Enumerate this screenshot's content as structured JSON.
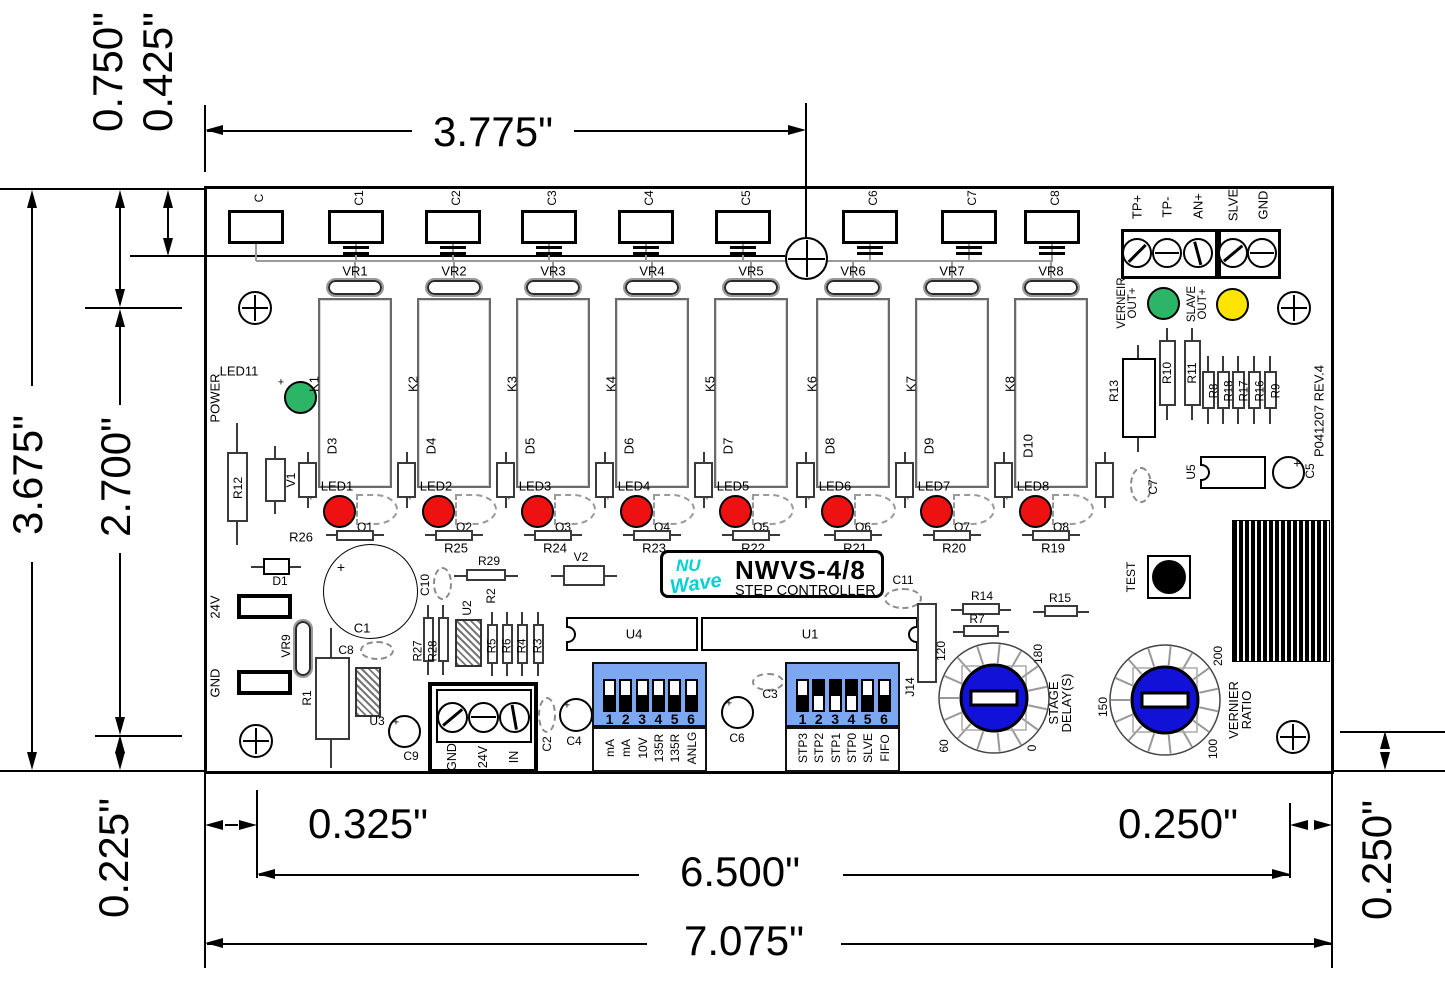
{
  "plus": "+",
  "dims": {
    "d0750": "0.750\"",
    "d0425": "0.425\"",
    "d3775": "3.775\"",
    "d3675": "3.675\"",
    "d2700": "2.700\"",
    "d0225": "0.225\"",
    "d0325": "0.325\"",
    "d6500": "6.500\"",
    "d0250b": "0.250\"",
    "d7075": "7.075\"",
    "d0250r": "0.250\""
  },
  "logo": {
    "nu": "NU",
    "wave": "Wave",
    "model": "NWVS-4/8",
    "subtitle": "STEP CONTROLLER",
    "accent": "#00d2d2"
  },
  "rev": "P041207 REV.4",
  "top_caps": [
    "C",
    "C1",
    "C2",
    "C3",
    "C4",
    "C5",
    "C6",
    "C7",
    "C8"
  ],
  "columns": [
    {
      "vr": "VR1",
      "k": "K1",
      "d": "D3",
      "led": "LED1",
      "q": "Q1",
      "r": "R26"
    },
    {
      "vr": "VR2",
      "k": "K2",
      "d": "D4",
      "led": "LED2",
      "q": "Q2",
      "r": "R25"
    },
    {
      "vr": "VR3",
      "k": "K3",
      "d": "D5",
      "led": "LED3",
      "q": "Q3",
      "r": "R24"
    },
    {
      "vr": "VR4",
      "k": "K4",
      "d": "D6",
      "led": "LED4",
      "q": "Q4",
      "r": "R23"
    },
    {
      "vr": "VR5",
      "k": "K5",
      "d": "D7",
      "led": "LED5",
      "q": "Q5",
      "r": "R22"
    },
    {
      "vr": "VR6",
      "k": "K6",
      "d": "D8",
      "led": "LED6",
      "q": "Q6",
      "r": "R21"
    },
    {
      "vr": "VR7",
      "k": "K7",
      "d": "D9",
      "led": "LED7",
      "q": "Q7",
      "r": "R20"
    },
    {
      "vr": "VR8",
      "k": "K8",
      "d": "D10",
      "led": "LED8",
      "q": "Q8",
      "r": "R19"
    }
  ],
  "io_block": {
    "labels": [
      "TP+",
      "TP-",
      "AN+",
      "SLVE",
      "GND"
    ]
  },
  "outputs": {
    "vernier_line1": "VERNEIR",
    "vernier_line2": "OUT",
    "vernier_color": "#2db567",
    "slave_line1": "SLAVE",
    "slave_line2": "OUT",
    "slave_color": "#ffe400"
  },
  "power": {
    "label": "POWER",
    "ref": "LED11",
    "color": "#2db567"
  },
  "right_parts": {
    "r13": "R13",
    "r10": "R10",
    "r11": "R11",
    "smalls": [
      "R8",
      "R18",
      "R17",
      "R16",
      "R9"
    ],
    "c7": "C7",
    "u5": "U5",
    "c5": "C5"
  },
  "test": {
    "label": "TEST"
  },
  "rotary_stage": {
    "line1": "STAGE",
    "line2": "DELAY(S)",
    "t0": "120",
    "t1": "180",
    "t2": "60",
    "t3": "0",
    "knob_color": "#1111d8"
  },
  "rotary_vernier": {
    "line1": "VERNIER",
    "line2": "RATIO",
    "t0": "150",
    "t1": "200",
    "t2": "100",
    "knob_color": "#1111d8"
  },
  "dip_s1": {
    "ref": "S1",
    "numbers": [
      "1",
      "2",
      "3",
      "4",
      "5",
      "6"
    ],
    "labels": [
      "mA",
      "mA",
      "10V",
      "135R",
      "135R",
      "ANLG"
    ],
    "positions": [
      "up",
      "up",
      "up",
      "up",
      "up",
      "up"
    ],
    "color": "#7da7f0"
  },
  "dip_s2": {
    "ref": "S2",
    "numbers": [
      "1",
      "2",
      "3",
      "4",
      "5",
      "6"
    ],
    "labels": [
      "STP3",
      "STP2",
      "STP1",
      "STP0",
      "SLVE",
      "FIFO"
    ],
    "positions": [
      "up",
      "down",
      "down",
      "down",
      "up",
      "up"
    ],
    "color": "#7da7f0"
  },
  "power_block": {
    "labels": [
      "GND",
      "24V",
      "IN"
    ]
  },
  "parts": {
    "r12": "R12",
    "v1": "V1",
    "d1": "D1",
    "pad_24v": "24V",
    "pad_gnd": "GND",
    "vr9": "VR9",
    "r1": "R1",
    "u3": "U3",
    "c9": "C9",
    "c1": "C1",
    "c8": "C8",
    "c10": "C10",
    "r29": "R29",
    "r2": "R2",
    "u2": "U2",
    "r27": "R27",
    "r28": "R28",
    "r5": "R5",
    "r6": "R6",
    "r4": "R4",
    "r3": "R3",
    "c2": "C2",
    "c4": "C4",
    "v2": "V2",
    "c6": "C6",
    "c3": "C3",
    "u4": "U4",
    "u1": "U1",
    "c11": "C11",
    "j14": "J14",
    "r14": "R14",
    "r7": "R7",
    "r15": "R15"
  },
  "led_colors": {
    "relay_led": "#ee1111"
  }
}
